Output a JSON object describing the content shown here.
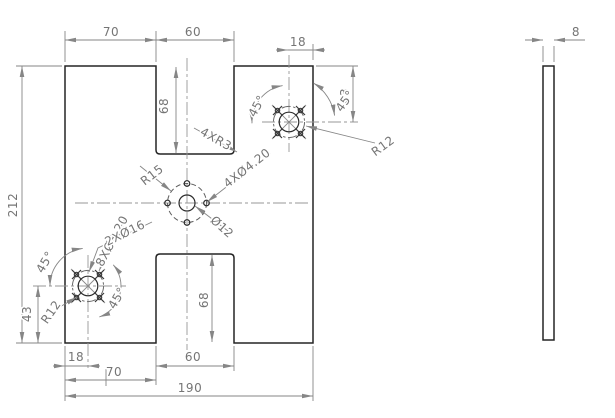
{
  "drawing": {
    "front_view": {
      "dims": {
        "top_segment": "70",
        "top_notch_width": "60",
        "top_notch_depth": "68",
        "tr_edge_offset": "18",
        "tr_vertical": "43",
        "overall_height": "212",
        "bl_vertical": "43",
        "bl_edge_offset": "18",
        "bottom_notch_width": "60",
        "bottom_segment": "70",
        "overall_width": "190",
        "bottom_notch_depth": "68"
      },
      "callouts": {
        "center_pattern_radius": "R15",
        "center_pattern_holes": "4XØ4.20",
        "center_hole_dia": "Ø12",
        "notch_fillets": "4XR3",
        "corner_pattern_holes": "8XØ3.20",
        "corner_center_holes": "2XØ16",
        "tr_pattern_radius": "R12",
        "bl_pattern_radius": "R12",
        "tr_angle_left": "45°",
        "tr_angle_right": "45°",
        "bl_angle_upper": "45°",
        "bl_angle_lower": "45°"
      }
    },
    "side_view": {
      "dims": {
        "thickness": "8"
      }
    },
    "colors": {
      "background": "#ffffff",
      "outline": "#252525",
      "dimension": "#868686",
      "text": "#757575",
      "centerline": "#979797"
    }
  }
}
